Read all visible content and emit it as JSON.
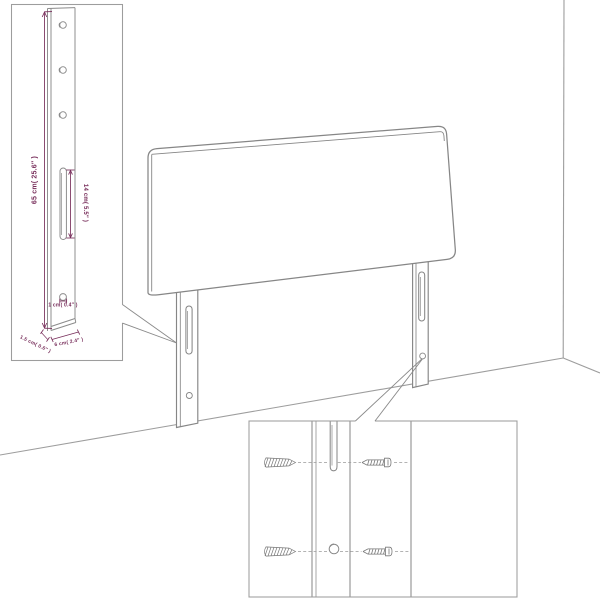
{
  "colors": {
    "background": "#ffffff",
    "outline": "#868686",
    "room_lines": "#9d9d9d",
    "dimension": "#772d5a"
  },
  "dimension_inset": {
    "labels": {
      "height": "65 cm( 25.6″ )",
      "slot_height": "14 cm( 5.5″ )",
      "hole_diameter": "1 cm( 0.4″ )",
      "thickness": "1.5 cm( 0.6″ )",
      "width": "6 cm( 2.4″ )"
    }
  },
  "mounting_inset": {
    "hardware_icons": [
      "wall-plug-icon",
      "screw-icon",
      "wall-plug-icon",
      "screw-icon"
    ]
  }
}
